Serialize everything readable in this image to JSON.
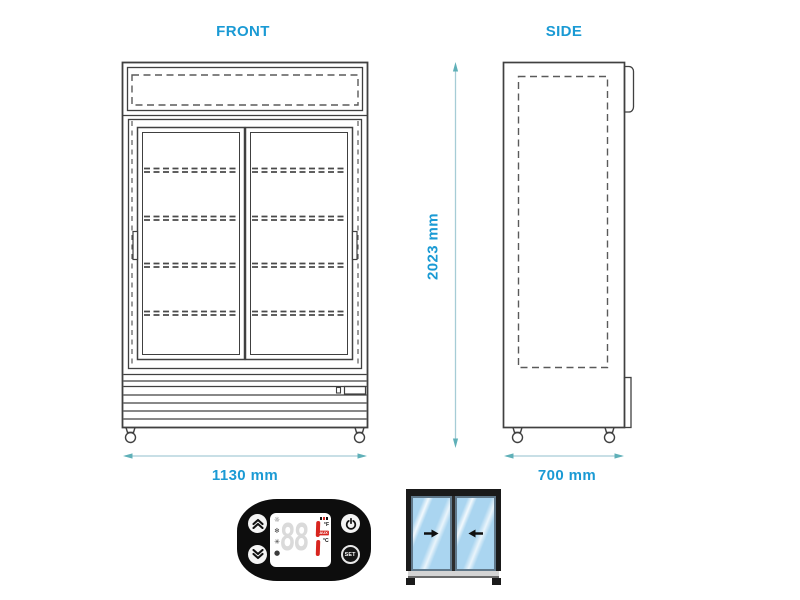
{
  "title_labels": {
    "front": "FRONT",
    "side": "SIDE"
  },
  "dimensions": {
    "front_width": "1130 mm",
    "height": "2023 mm",
    "side_depth": "700 mm"
  },
  "views": {
    "front": {
      "shelf_rows": 4,
      "doors": 2,
      "handles": 2,
      "casters": 2
    },
    "side": {
      "casters": 2
    }
  },
  "controller": {
    "set_label": "SET",
    "display": {
      "ghost_digits": "88",
      "fahrenheit": "°F",
      "aux": "AUX",
      "celsius": "°C"
    },
    "icons": {
      "buttons": [
        "chevron-up-icon",
        "chevron-down-icon",
        "power-icon",
        "set-button"
      ],
      "display_left_column": [
        "light-icon",
        "defrost-icon",
        "fan-icon",
        "compressor-icon"
      ],
      "display_right_column": [
        "alarm-indicator",
        "fahrenheit-label",
        "aux-indicator",
        "celsius-label"
      ]
    }
  },
  "door_inset": {
    "left_door_arrow": "slide-right",
    "right_door_arrow": "slide-left"
  },
  "colors": {
    "label_blue": "#1a9ad4",
    "dimension_line": "#a6ccd6",
    "dimension_arrow": "#5fb0b8",
    "drawing_line": "#404040",
    "glass_blue": "#aad5f0",
    "display_red": "#d8251f",
    "panel_black": "#0d0d0d"
  }
}
